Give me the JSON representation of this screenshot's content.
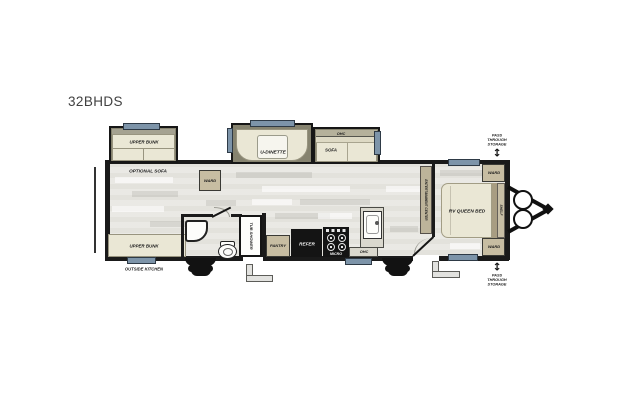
{
  "title": "32BHDS",
  "colors": {
    "wall": "#1a1a1a",
    "window": "#7d94a9",
    "floor": "#e9e8e3",
    "furniture_cream": "#eae7d5",
    "cabinet_tan": "#c7bda2",
    "slideout_olive": "#86836f",
    "appliance_black": "#141414"
  },
  "floorplan": {
    "labels": {
      "upper_bunk": "UPPER BUNK",
      "optional_sofa": "OPTIONAL SOFA",
      "ward": "WARD",
      "u_dinette": "U-DINETTE",
      "ohc": "OHC",
      "sofa": "SOFA",
      "entertainment_center": "ENTERTAINMENT CENTER",
      "pass_through_storage": "PASS THROUGH STORAGE",
      "rv_queen_bed": "RV QUEEN BED",
      "shelf": "SHELF",
      "tub_shower": "TUB SHOWER",
      "pantry": "PANTRY",
      "refer": "REFER",
      "micro": "MICRO",
      "outside_kitchen": "OUTSIDE KITCHEN",
      "arrow_up_down": "↕"
    }
  }
}
